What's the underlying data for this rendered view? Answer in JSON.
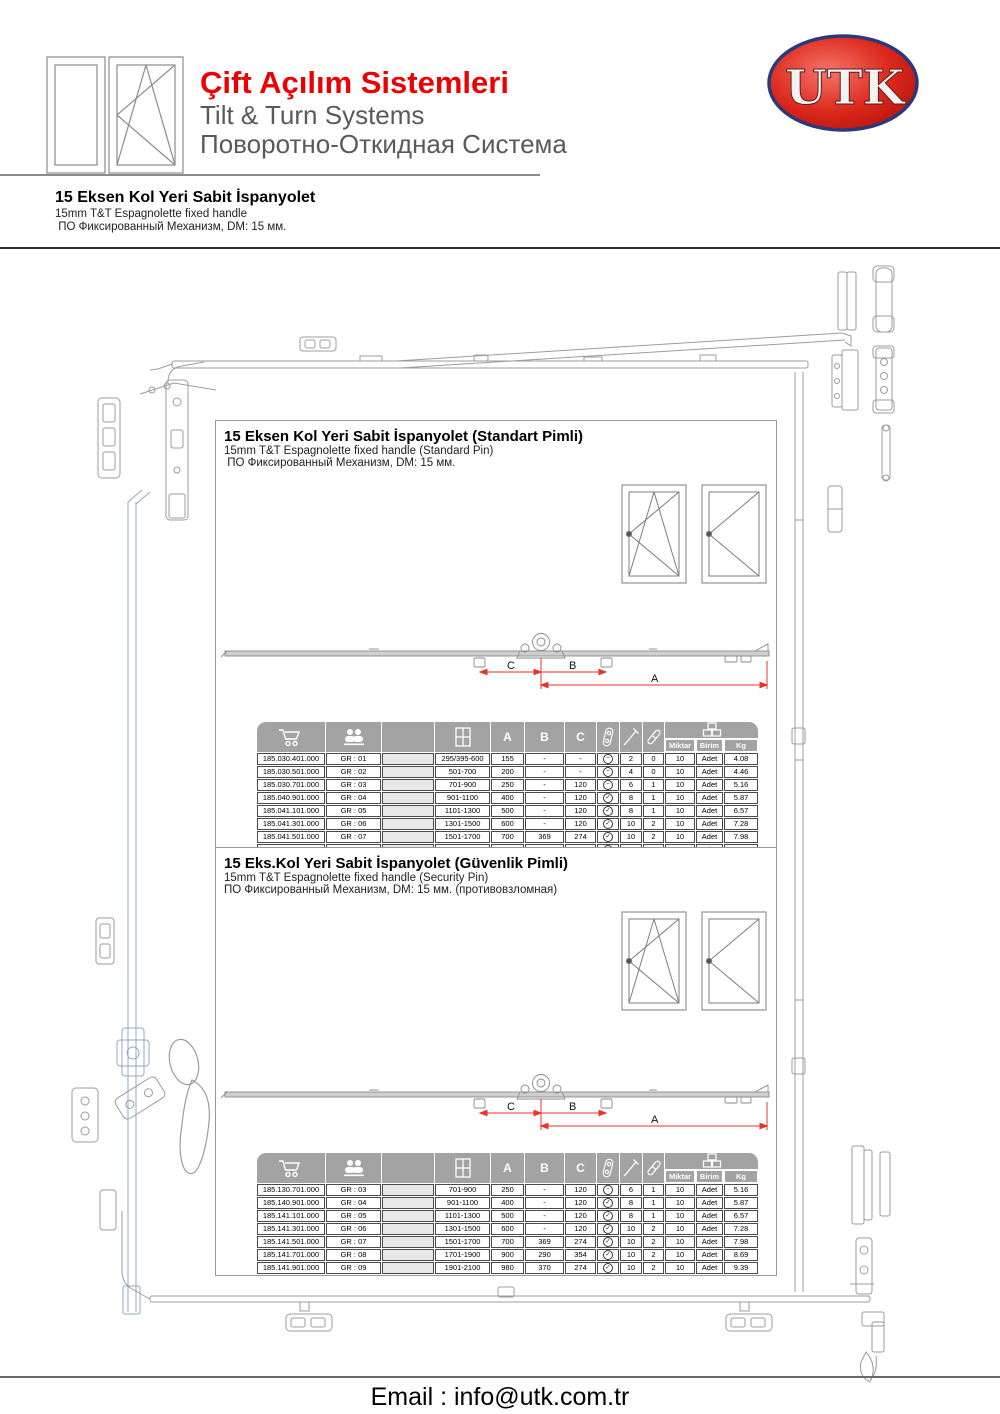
{
  "header": {
    "title_tr": "Çift Açılım Sistemleri",
    "title_en": "Tilt & Turn Systems",
    "title_ru": "Поворотно-Откидная Система",
    "logo_text": "UTK"
  },
  "intro": {
    "title": "15 Eksen Kol Yeri Sabit İspanyolet",
    "subtitle_en": "15mm T&T Espagnolette fixed handle",
    "subtitle_ru": " ПО Фиксированный Механизм, DM: 15 мм."
  },
  "icons": {
    "table_header": [
      "cart-icon",
      "group-icon",
      "window-grid-icon",
      "cam-pin-icon",
      "screw-icon",
      "pin-icon",
      "package-icon"
    ],
    "row_status": {
      "minus": "minus-circle-icon",
      "check": "check-circle-icon"
    }
  },
  "colors": {
    "accent_red": "#ee0000",
    "logo_red": "#d61a1a",
    "logo_border": "#2b3a77",
    "table_header_gray": "#a3a3a3",
    "dimension_red": "#e8342a",
    "drawing_gray": "#9c9c9c",
    "drawing_blue": "#8fa9c8"
  },
  "sections": [
    {
      "title": "15 Eksen Kol Yeri Sabit İspanyolet (Standart Pimli)",
      "subtitle_en": "15mm T&T Espagnolette fixed handle (Standard Pin)",
      "subtitle_ru": " ПО Фиксированный Механизм, DM: 15 мм.",
      "dimension_labels": [
        "C",
        "B",
        "A"
      ],
      "table": {
        "column_letters": [
          "A",
          "B",
          "C"
        ],
        "subheaders": [
          "Miktar",
          "Birim",
          "Kg"
        ],
        "rows": [
          [
            "185.030.401.000",
            "GR : 01",
            "",
            "295/395-600",
            "155",
            "-",
            "-",
            "minus",
            "2",
            "0",
            "10",
            "Adet",
            "4.08"
          ],
          [
            "185.030.501.000",
            "GR : 02",
            "",
            "501-700",
            "200",
            "-",
            "-",
            "minus",
            "4",
            "0",
            "10",
            "Adet",
            "4.46"
          ],
          [
            "185.030.701.000",
            "GR : 03",
            "",
            "701-900",
            "250",
            "-",
            "120",
            "minus",
            "6",
            "1",
            "10",
            "Adet",
            "5.16"
          ],
          [
            "185.040.901.000",
            "GR : 04",
            "",
            "901-1100",
            "400",
            "-",
            "120",
            "check",
            "8",
            "1",
            "10",
            "Adet",
            "5.87"
          ],
          [
            "185.041.101.000",
            "GR : 05",
            "",
            "1101-1300",
            "500",
            "-",
            "120",
            "check",
            "8",
            "1",
            "10",
            "Adet",
            "6.57"
          ],
          [
            "185.041.301.000",
            "GR : 06",
            "",
            "1301-1500",
            "600",
            "-",
            "120",
            "check",
            "10",
            "2",
            "10",
            "Adet",
            "7.28"
          ],
          [
            "185.041.501.000",
            "GR : 07",
            "",
            "1501-1700",
            "700",
            "369",
            "274",
            "check",
            "10",
            "2",
            "10",
            "Adet",
            "7.98"
          ],
          [
            "185.041.701.000",
            "GR : 08",
            "",
            "1701-1900",
            "900",
            "290",
            "354",
            "check",
            "10",
            "2",
            "10",
            "Adet",
            "8.69"
          ],
          [
            "185.041.901.000",
            "GR : 09",
            "",
            "1901-2100",
            "980",
            "370",
            "274",
            "check",
            "10",
            "2",
            "10",
            "Adet",
            "9.39"
          ]
        ]
      }
    },
    {
      "title": "15 Eks.Kol Yeri Sabit İspanyolet (Güvenlik Pimli)",
      "subtitle_en": "15mm T&T Espagnolette fixed handle (Security Pin)",
      "subtitle_ru": "ПО Фиксированный Механизм, DM: 15 мм. (противовзломная)",
      "dimension_labels": [
        "C",
        "B",
        "A"
      ],
      "table": {
        "column_letters": [
          "A",
          "B",
          "C"
        ],
        "subheaders": [
          "Miktar",
          "Birim",
          "Kg"
        ],
        "rows": [
          [
            "185.130.701.000",
            "GR : 03",
            "",
            "701-900",
            "250",
            "-",
            "120",
            "minus",
            "6",
            "1",
            "10",
            "Adet",
            "5.16"
          ],
          [
            "185.140.901.000",
            "GR : 04",
            "",
            "901-1100",
            "400",
            "-",
            "120",
            "check",
            "8",
            "1",
            "10",
            "Adet",
            "5.87"
          ],
          [
            "185.141.101.000",
            "GR : 05",
            "",
            "1101-1300",
            "500",
            "-",
            "120",
            "check",
            "8",
            "1",
            "10",
            "Adet",
            "6.57"
          ],
          [
            "185.141.301.000",
            "GR : 06",
            "",
            "1301-1500",
            "600",
            "-",
            "120",
            "check",
            "10",
            "2",
            "10",
            "Adet",
            "7.28"
          ],
          [
            "185.141.501.000",
            "GR : 07",
            "",
            "1501-1700",
            "700",
            "369",
            "274",
            "check",
            "10",
            "2",
            "10",
            "Adet",
            "7.98"
          ],
          [
            "185.141.701.000",
            "GR : 08",
            "",
            "1701-1900",
            "900",
            "290",
            "354",
            "check",
            "10",
            "2",
            "10",
            "Adet",
            "8.69"
          ],
          [
            "185.141.901.000",
            "GR : 09",
            "",
            "1901-2100",
            "980",
            "370",
            "274",
            "check",
            "10",
            "2",
            "10",
            "Adet",
            "9.39"
          ]
        ]
      }
    }
  ],
  "footer": {
    "email": "Email : info@utk.com.tr"
  }
}
